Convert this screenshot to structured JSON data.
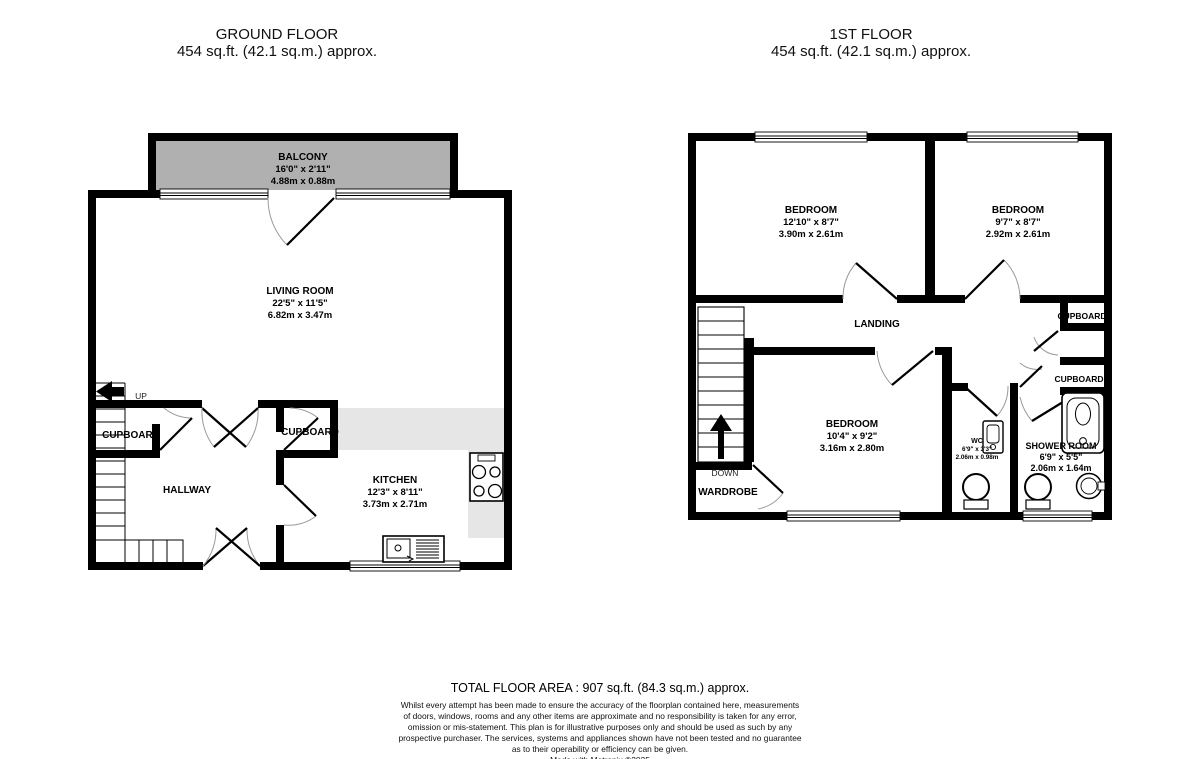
{
  "ground_floor": {
    "title": "GROUND FLOOR",
    "area_line": "454 sq.ft. (42.1 sq.m.) approx.",
    "balcony": {
      "name": "BALCONY",
      "imperial": "16'0\" x 2'11\"",
      "metric": "4.88m x 0.88m"
    },
    "living_room": {
      "name": "LIVING ROOM",
      "imperial": "22'5\" x 11'5\"",
      "metric": "6.82m x 3.47m"
    },
    "kitchen": {
      "name": "KITCHEN",
      "imperial": "12'3\" x 8'11\"",
      "metric": "3.73m x 2.71m"
    },
    "hallway": {
      "name": "HALLWAY"
    },
    "cupboard_left": {
      "name": "CUPBOARD"
    },
    "cupboard_mid": {
      "name": "CUPBOARD"
    },
    "up_label": "UP"
  },
  "first_floor": {
    "title": "1ST FLOOR",
    "area_line": "454 sq.ft. (42.1 sq.m.) approx.",
    "bedroom1": {
      "name": "BEDROOM",
      "imperial": "12'10\" x 8'7\"",
      "metric": "3.90m x 2.61m"
    },
    "bedroom2": {
      "name": "BEDROOM",
      "imperial": "9'7\" x 8'7\"",
      "metric": "2.92m x 2.61m"
    },
    "bedroom3": {
      "name": "BEDROOM",
      "imperial": "10'4\" x 9'2\"",
      "metric": "3.16m x 2.80m"
    },
    "landing": {
      "name": "LANDING"
    },
    "wardrobe": {
      "name": "WARDROBE"
    },
    "cupboard_top": {
      "name": "CUPBOARD"
    },
    "cupboard_bottom": {
      "name": "CUPBOARD"
    },
    "wc": {
      "name": "WC",
      "imperial": "6'9\" x 3'3\"",
      "metric": "2.06m x 0.98m"
    },
    "shower_room": {
      "name": "SHOWER ROOM",
      "imperial": "6'9\" x 5'5\"",
      "metric": "2.06m x 1.64m"
    },
    "down_label": "DOWN"
  },
  "footer": {
    "total_area": "TOTAL FLOOR AREA : 907 sq.ft. (84.3 sq.m.) approx.",
    "disclaimer_lines": [
      "Whilst every attempt has been made to ensure the accuracy of the floorplan contained here, measurements",
      "of doors, windows, rooms and any other items are approximate and no responsibility is taken for any error,",
      "omission or mis-statement. This plan is for illustrative purposes only and should be used as such by any",
      "prospective purchaser. The services, systems and appliances shown have not been tested and no guarantee",
      "as to their operability or efficiency can be given."
    ],
    "credit": "Made with Metropix ©2025"
  },
  "colors": {
    "wall": "#000000",
    "balcony_fill": "#b0b0b0",
    "counter_fill": "#e6e6e6"
  }
}
